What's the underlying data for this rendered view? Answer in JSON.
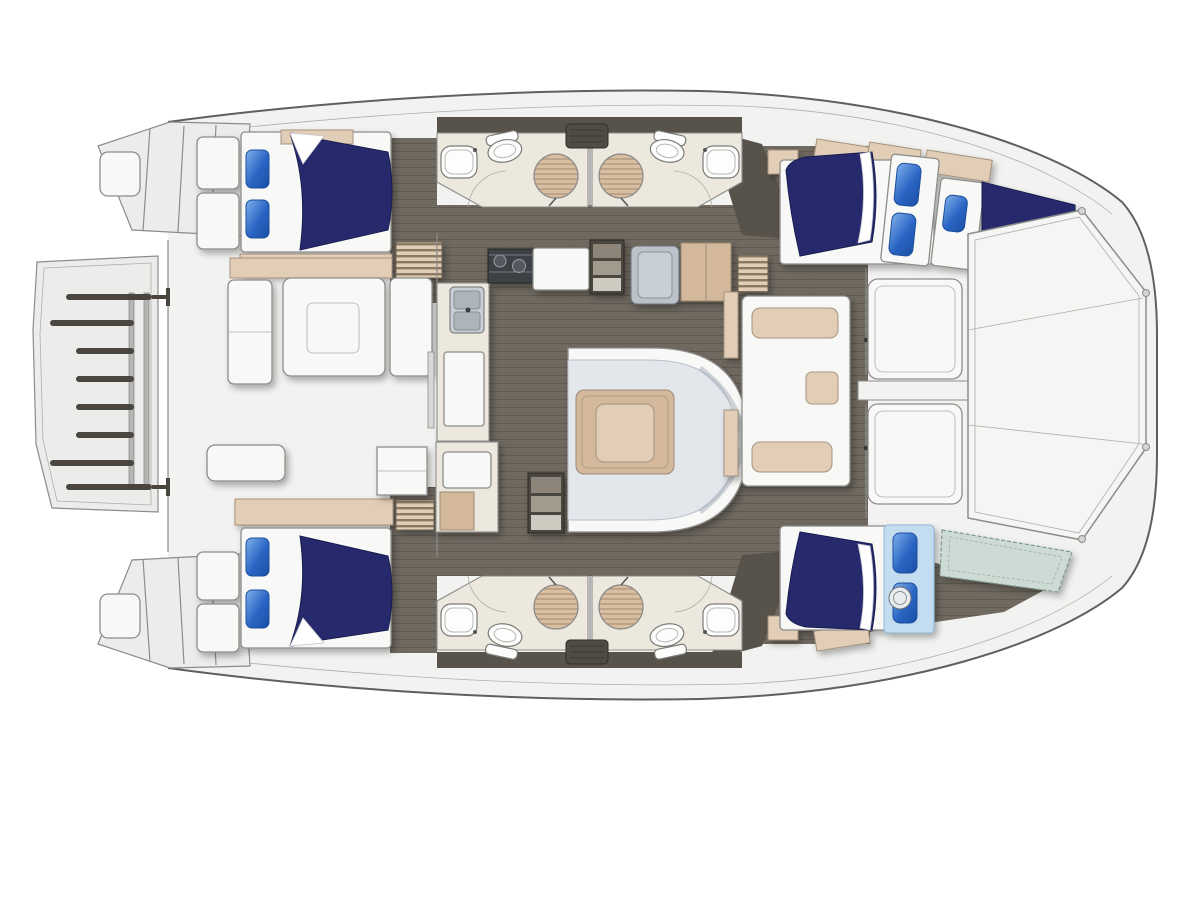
{
  "colors": {
    "white": "#ffffff",
    "hull": "#f2f2f0",
    "hull2": "#ececea",
    "outline": "#5f5f5d",
    "line": "#8c8c8a",
    "walk": "#57534b",
    "floor": "#6f6960",
    "plank": "#5f594f",
    "cream": "#ece8dd",
    "settee": "#e3e7ec",
    "beige": "#d3b89c",
    "beige2": "#e2cdb6",
    "navy": "#272c6d",
    "navy2": "#181c4e",
    "pillow": "#2f6fd0",
    "pillow2": "#7fb0ea",
    "sheet": "#c3dcef",
    "teal": "#ccdcd5",
    "steel": "#bcc2c9",
    "dark": "#4a463f",
    "white_furn": "#f8f8f6"
  },
  "vessel": {
    "type": "Catamaran yacht deck and interior floor plan",
    "view": "overhead plan, bow to the right",
    "hulls": 2,
    "cabins": [
      {
        "location": "port aft",
        "bed": "double berth",
        "duvet": "navy",
        "pillows": 2
      },
      {
        "location": "port forward",
        "bed": "double berth plus forepeak single berth",
        "duvet": "navy",
        "pillows": 3
      },
      {
        "location": "starboard aft",
        "bed": "double berth",
        "duvet": "navy",
        "pillows": 2
      },
      {
        "location": "starboard forward",
        "bed": "double berth plus forepeak berth cushion",
        "duvet": "navy",
        "pillows": 2
      }
    ],
    "heads": [
      {
        "location": "port aft head",
        "fixtures": [
          "toilet",
          "sink",
          "shower mat"
        ]
      },
      {
        "location": "port forward head",
        "fixtures": [
          "toilet",
          "sink",
          "shower mat"
        ]
      },
      {
        "location": "starboard aft head",
        "fixtures": [
          "toilet",
          "sink",
          "shower mat"
        ]
      },
      {
        "location": "starboard forward head",
        "fixtures": [
          "toilet",
          "sink",
          "shower mat"
        ]
      }
    ],
    "salon": {
      "galley": [
        "double stainless sink",
        "stove with burners",
        "refrigerator",
        "counters",
        "storage cabinets"
      ],
      "dinette": "C-shaped settee with square table",
      "steps": [
        "steps down to port hull",
        "steps down to starboard hull"
      ]
    },
    "aft_cockpit": {
      "furniture": [
        "bench seat",
        "cockpit table",
        "side seat",
        "aft bench"
      ]
    },
    "stern": {
      "platform": "swim platform with davit rails and cross bars",
      "transoms": "boarding steps on both hulls"
    },
    "bow": {
      "features": [
        "forward cockpit seats",
        "forward crossbeam",
        "trampoline panel"
      ]
    }
  }
}
